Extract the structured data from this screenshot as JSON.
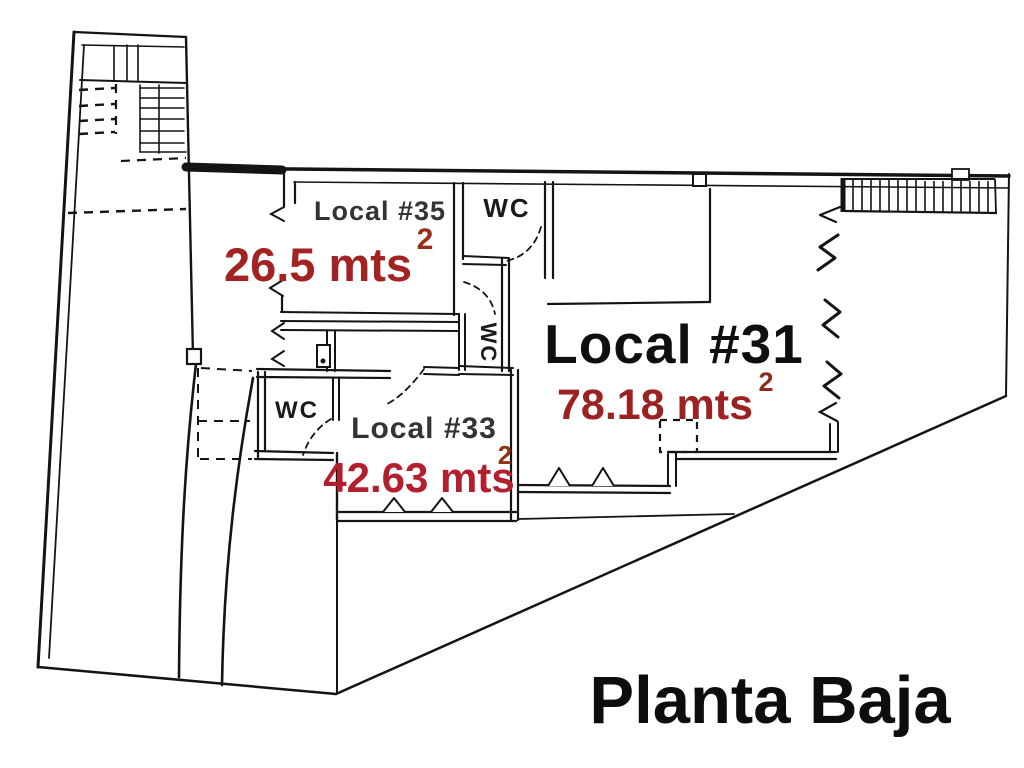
{
  "title": "Planta Baja",
  "rooms": [
    {
      "name": "Local #35",
      "area": "26.5 mts",
      "area_sup": "2"
    },
    {
      "name": "Local #31",
      "area": "78.18 mts",
      "area_sup": "2"
    },
    {
      "name": "Local #33",
      "area": "42.63 mts",
      "area_sup": "2"
    }
  ],
  "wc": {
    "top": "WC",
    "middle": "WC",
    "local33": "WC"
  },
  "colors": {
    "line": "#141414",
    "room_name": "#333333",
    "room_name_big": "#0f0f0f",
    "wc_text": "#1b1b1b",
    "area_red_35": "#a32222",
    "area_red_31": "#9c2121",
    "area_red_33": "#b2202e",
    "sup_red_35": "#9c2c1a",
    "sup_red_31": "#8d2e1c",
    "sup_red_33": "#8c3414",
    "title_black": "#0d0d0d"
  }
}
